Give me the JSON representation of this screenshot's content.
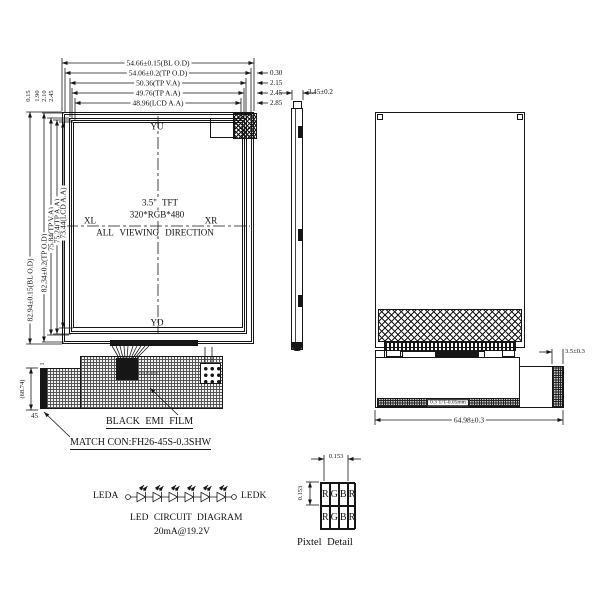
{
  "front": {
    "top_dims": [
      {
        "label": "54.66±0.15(BL O.D)"
      },
      {
        "label": "54.06±0.2(TP O.D)",
        "offset": "0.30"
      },
      {
        "label": "50.36(TP V.A)",
        "offset": "2.15"
      },
      {
        "label": "49.76(TP A.A)",
        "offset": "2.45"
      },
      {
        "label": "48.96(LCD A.A)",
        "offset": "2.85"
      }
    ],
    "left_dims": [
      {
        "label": "82.94±0.15(BL O.D)"
      },
      {
        "label": "82.34±0.2(TP O.D)",
        "offset": "0.15"
      },
      {
        "label": "75.84(TP V.A)",
        "offset": "1.90"
      },
      {
        "label": "75.24(TP A.A)",
        "offset": "2.10"
      },
      {
        "label": "73.44(LCD A.A)",
        "offset": "2.45"
      }
    ],
    "axis": {
      "top": "YU",
      "bottom": "YD",
      "left": "XL",
      "right": "XR"
    },
    "center": [
      "3.5\" TFT",
      "320*RGB*480"
    ],
    "viewing": "ALL VIEWING DIRECTION",
    "fpc": {
      "pin_first": "1",
      "pin_last": "45",
      "ref_dim": "(68.74)",
      "pin_note": "PIN45 PIN1"
    },
    "notes": {
      "emi": "BLACK EMI FILM",
      "connector": "MATCH CON:FH26-45S-0.3SHW"
    }
  },
  "side": {
    "thickness": "3.45±0.2"
  },
  "back": {
    "fpc_width": "64.98±0.3",
    "stiffener_width": "3.5±0.3",
    "fpc_thickness": "0.3 T/T-0.05mm"
  },
  "led": {
    "anode": "LEDA",
    "cathode": "LEDK",
    "title": "LED CIRCUIT DIAGRAM",
    "rating": "20mA@19.2V",
    "count": 6
  },
  "pixel": {
    "pitch_h": "0.153",
    "pitch_v": "0.153",
    "rows": [
      [
        "R",
        "G",
        "B",
        "R"
      ],
      [
        "R",
        "G",
        "B",
        "R"
      ]
    ],
    "caption": "Pixtel Detail"
  }
}
